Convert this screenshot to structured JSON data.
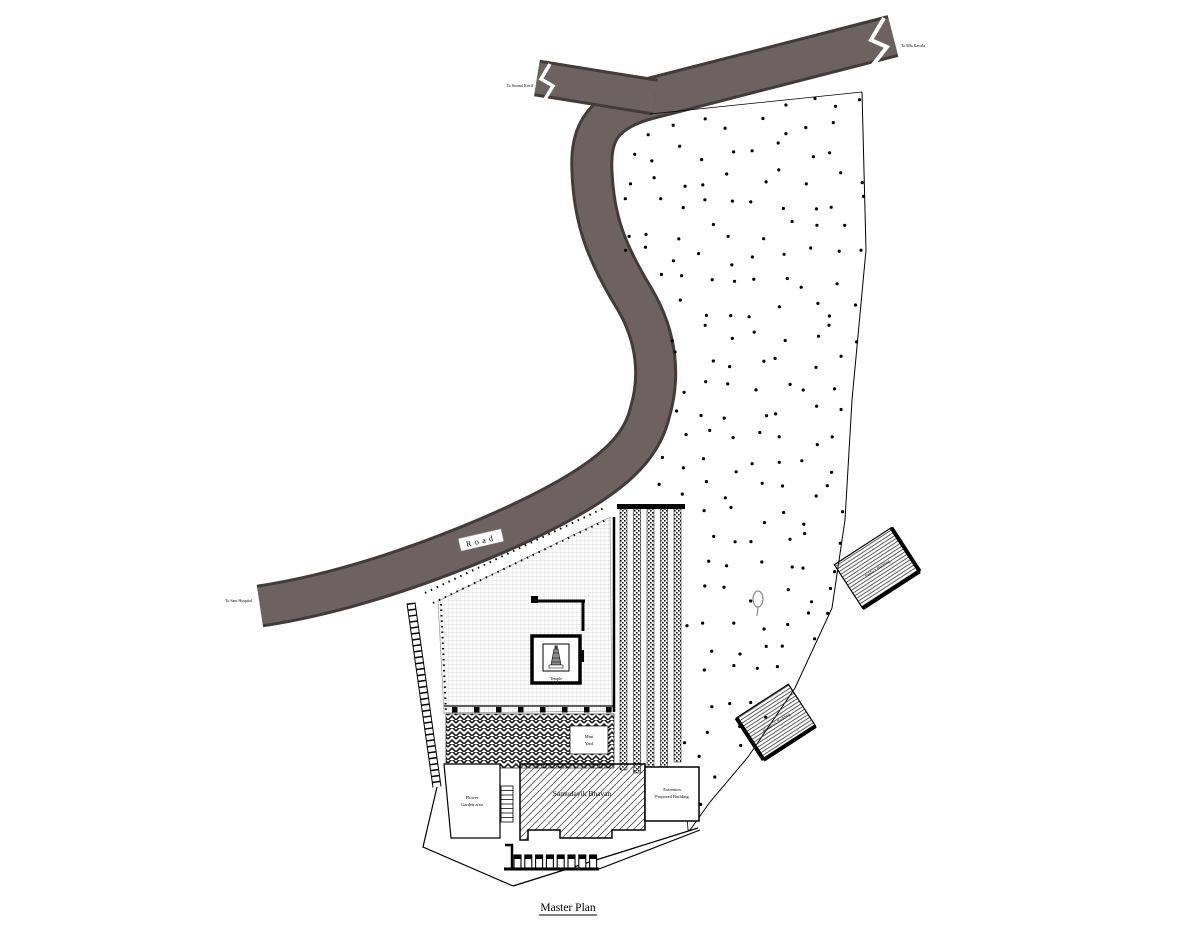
{
  "title": "Master Plan",
  "road": {
    "label": "Road",
    "destination_north_east": "To Mla Kavala",
    "destination_north_west": "To Swami Kovil",
    "destination_west": "To Sant Hospital"
  },
  "site": {
    "temple": {
      "label": "Temple"
    },
    "mini_yard": {
      "line1": "Mini",
      "line2": "Yard"
    },
    "samudayik_bhavan": {
      "label": "Samudayik Bhavan"
    },
    "extension_building": {
      "line1": "Extention",
      "line2": "Proposed Building"
    },
    "flower_garden": {
      "line1": "Flower",
      "line2": "Garden area"
    },
    "publics_building": {
      "label": "Public's Building"
    },
    "mathews_building": {
      "label": "Mathew's Building"
    },
    "planted_area": {
      "texture": "scattered planting dots"
    }
  },
  "colors": {
    "road_fill": "#6d6260",
    "road_edge": "#423b37",
    "ink": "#000000",
    "grid_line": "#c4c4c4"
  }
}
